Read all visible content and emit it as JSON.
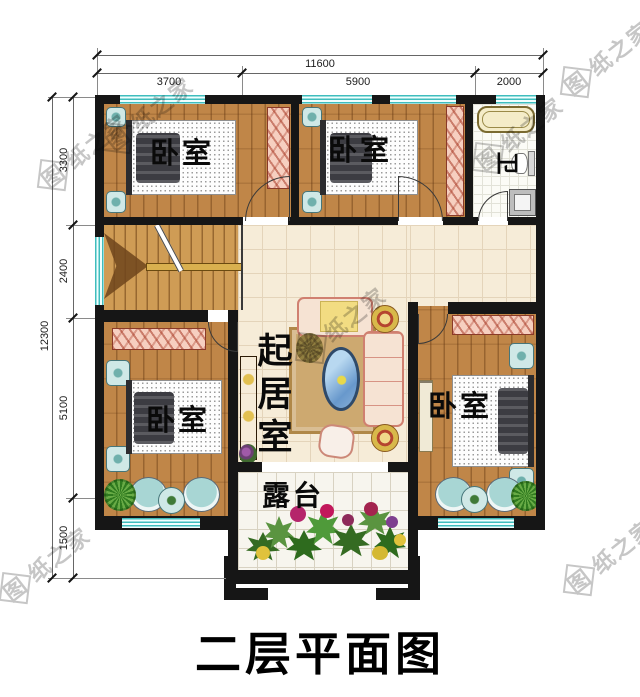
{
  "title": "二层平面图",
  "watermark": "图纸之家",
  "dimensions": {
    "top": {
      "total": "11600",
      "segments": [
        "3700",
        "5900",
        "2000"
      ]
    },
    "left": {
      "total": "12300",
      "segments": [
        "3300",
        "2400",
        "5100",
        "1500"
      ]
    }
  },
  "rooms": {
    "bedroom_nw": "卧室",
    "bedroom_n": "卧室",
    "bathroom": "卫",
    "living": "起居室",
    "bedroom_sw": "卧室",
    "bedroom_se": "卧室",
    "terrace": "露台"
  },
  "colors": {
    "wall": "#161616",
    "window": "#3fbdbd",
    "wood_floor": "#c08648",
    "tile_floor": "#f6ecd8",
    "wardrobe": "#f6cfc0",
    "watermark": "#bcbcbc"
  }
}
